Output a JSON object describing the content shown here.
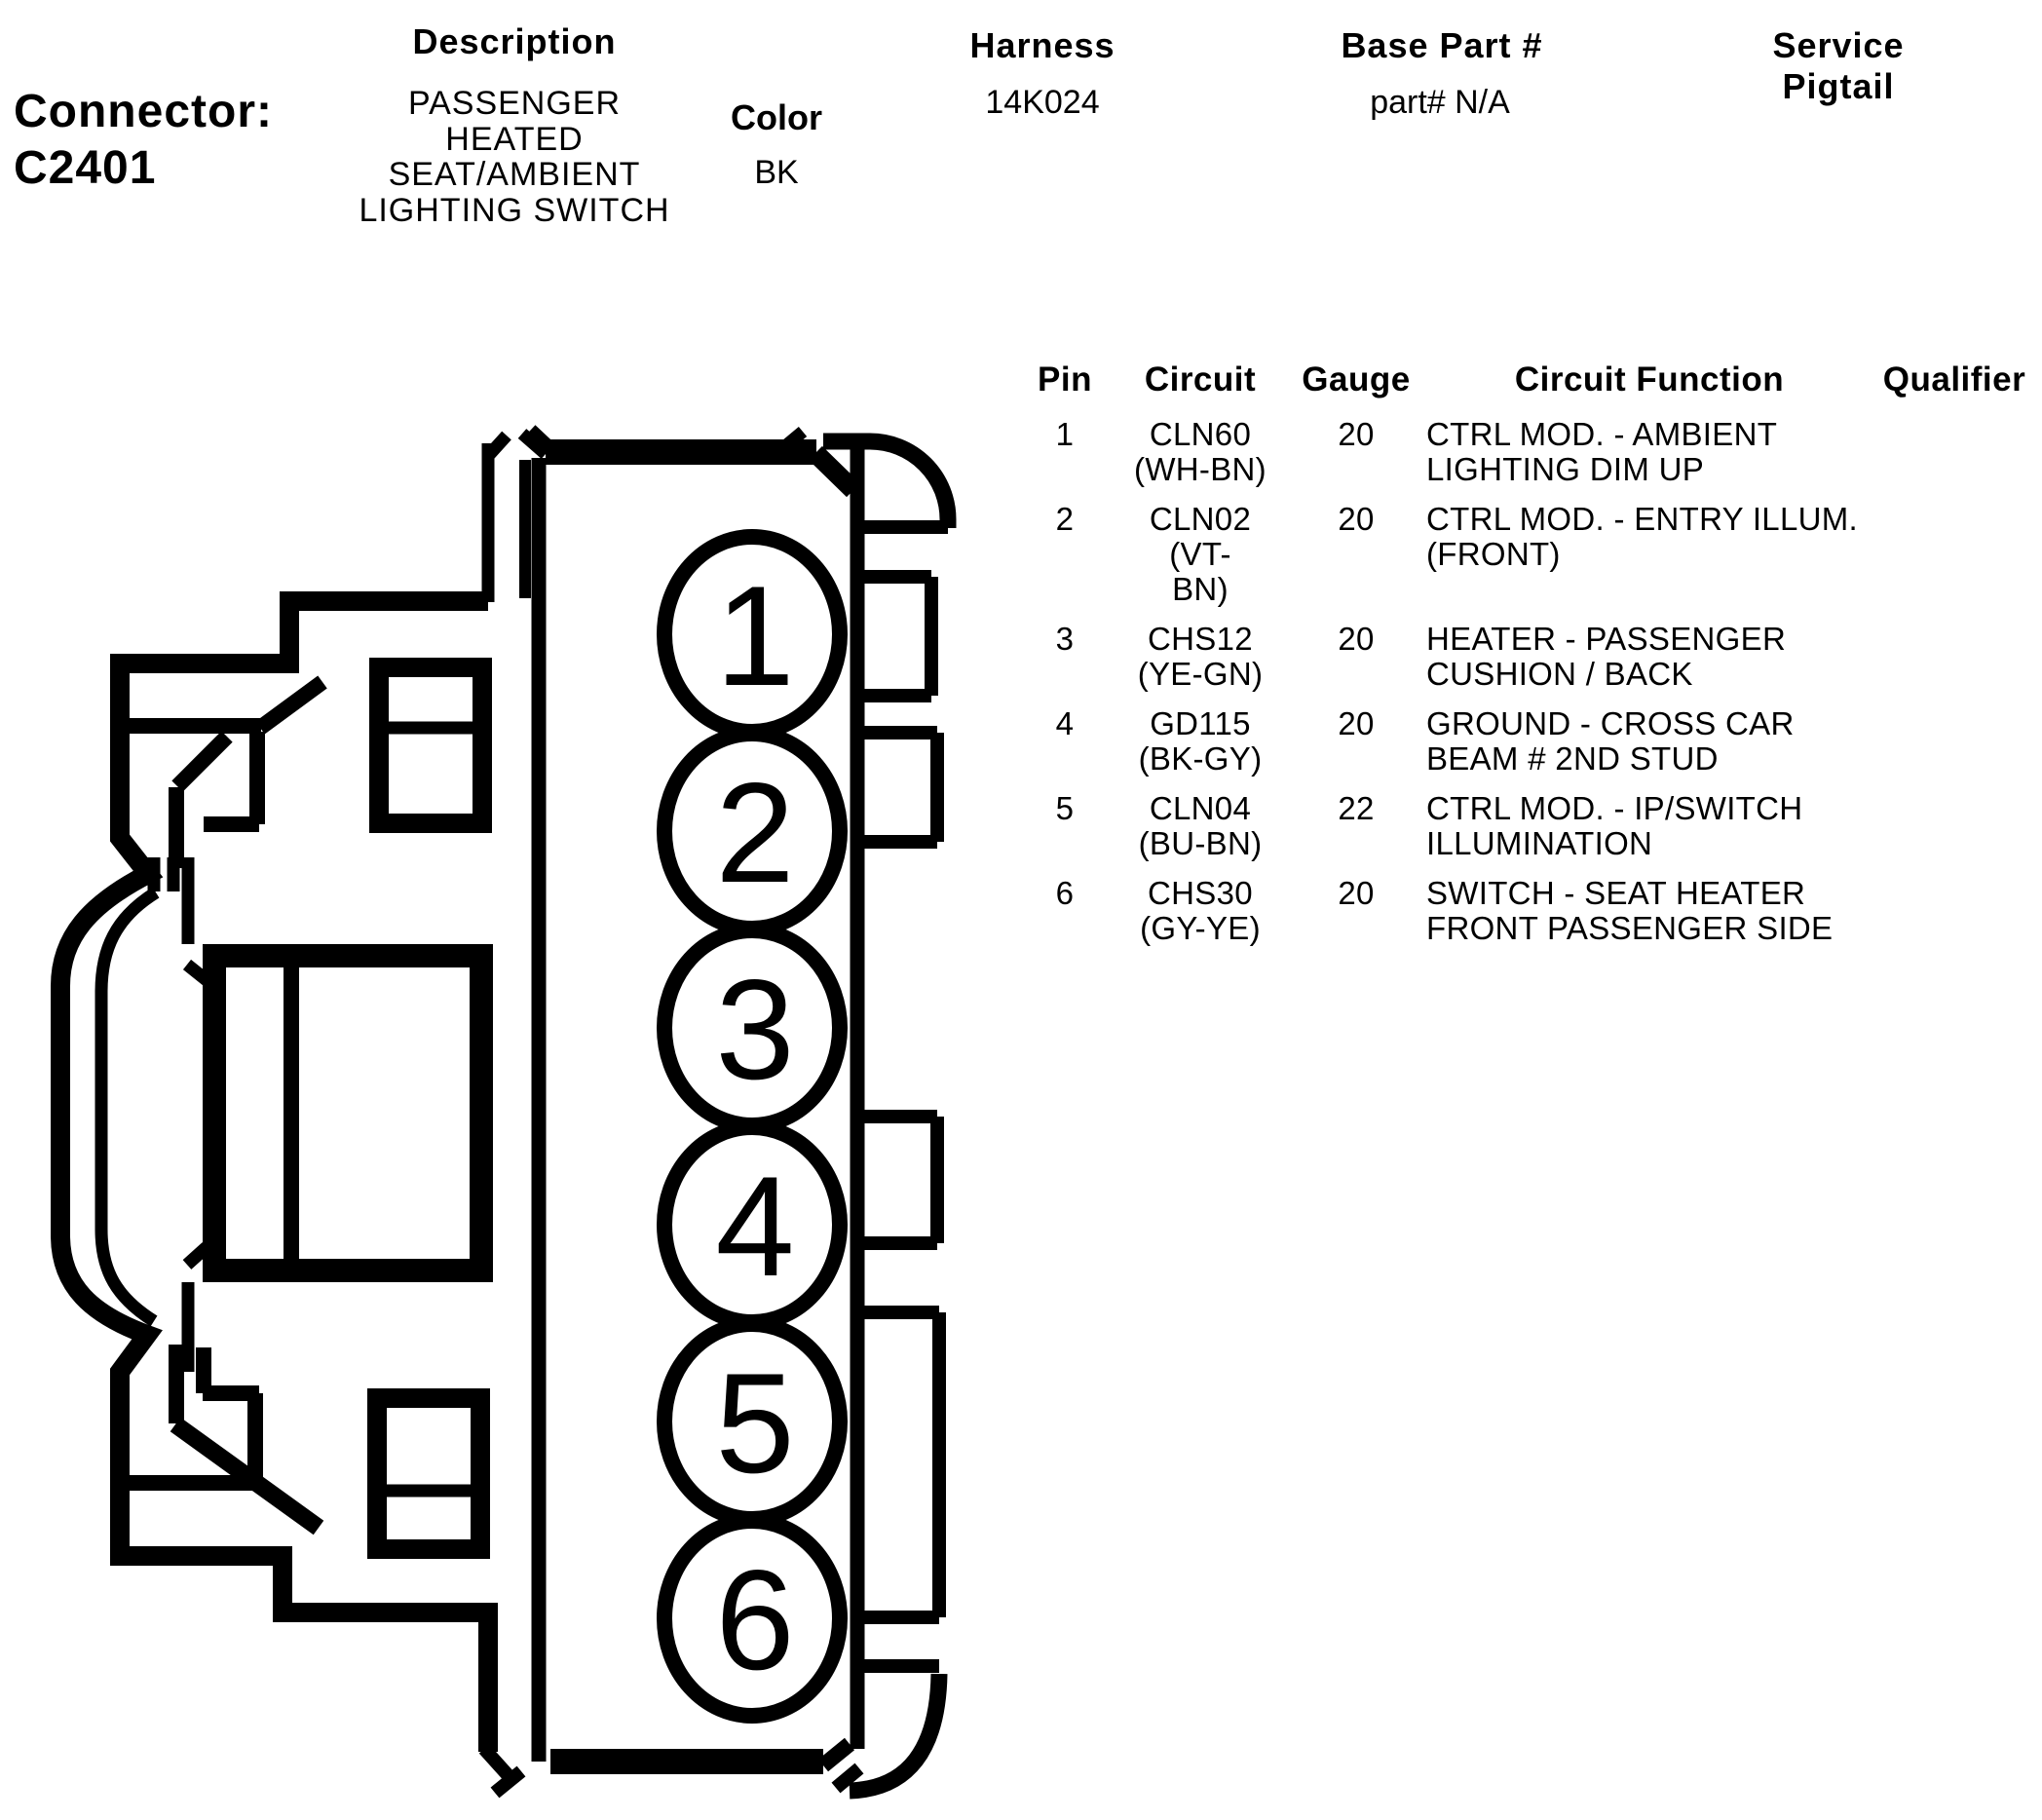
{
  "connector": {
    "label": "Connector:",
    "id": "C2401"
  },
  "header": {
    "description_label": "Description",
    "description_lines": [
      "PASSENGER",
      "HEATED",
      "SEAT/AMBIENT",
      "LIGHTING SWITCH"
    ],
    "color_label": "Color",
    "color_value": "BK",
    "harness_label": "Harness",
    "harness_value": "14K024",
    "base_part_label": "Base Part #",
    "base_part_value": "part# N/A",
    "service_pigtail_label": "Service Pigtail",
    "service_pigtail_value": ""
  },
  "diagram": {
    "pins": [
      "1",
      "2",
      "3",
      "4",
      "5",
      "6"
    ]
  },
  "table": {
    "columns": [
      "Pin",
      "Circuit",
      "Gauge",
      "Circuit Function",
      "Qualifier"
    ],
    "rows": [
      {
        "pin": "1",
        "circuit": [
          "CLN60",
          "(WH-BN)"
        ],
        "gauge": "20",
        "function": [
          "CTRL MOD. - AMBIENT",
          "LIGHTING DIM UP"
        ],
        "qualifier": ""
      },
      {
        "pin": "2",
        "circuit": [
          "CLN02 (VT-",
          "BN)"
        ],
        "gauge": "20",
        "function": [
          "CTRL MOD. - ENTRY ILLUM.",
          "(FRONT)"
        ],
        "qualifier": ""
      },
      {
        "pin": "3",
        "circuit": [
          "CHS12",
          "(YE-GN)"
        ],
        "gauge": "20",
        "function": [
          "HEATER - PASSENGER",
          "CUSHION / BACK"
        ],
        "qualifier": ""
      },
      {
        "pin": "4",
        "circuit": [
          "GD115",
          "(BK-GY)"
        ],
        "gauge": "20",
        "function": [
          "GROUND - CROSS CAR",
          "BEAM # 2ND STUD"
        ],
        "qualifier": ""
      },
      {
        "pin": "5",
        "circuit": [
          "CLN04",
          "(BU-BN)"
        ],
        "gauge": "22",
        "function": [
          "CTRL MOD. - IP/SWITCH",
          "ILLUMINATION"
        ],
        "qualifier": ""
      },
      {
        "pin": "6",
        "circuit": [
          "CHS30",
          "(GY-YE)"
        ],
        "gauge": "20",
        "function": [
          "SWITCH - SEAT HEATER",
          "FRONT PASSENGER SIDE"
        ],
        "qualifier": ""
      }
    ]
  }
}
